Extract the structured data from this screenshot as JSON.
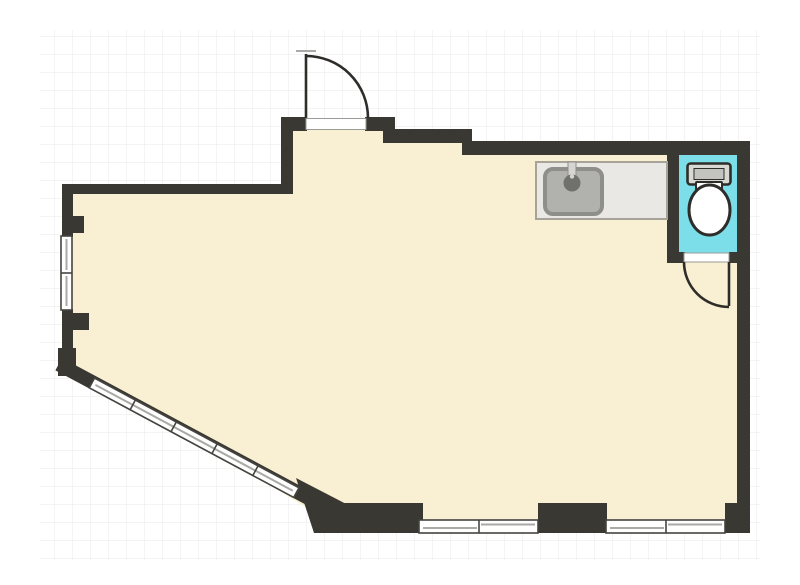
{
  "canvas": {
    "width": 800,
    "height": 585,
    "kind": "architectural-floor-plan"
  },
  "colors": {
    "background": "#ffffff",
    "grid_line": "#eaeaea",
    "wall": "#3a3833",
    "floor": "#f9efd2",
    "toilet_floor": "#7bdee9",
    "counter_fill": "#e9e8e4",
    "counter_border": "#a7a399",
    "sink_fill": "#b1b1ad",
    "sink_border": "#8e8e8a",
    "faucet": "#70706c",
    "faucet_stem": "#d6d5d1",
    "fixture_outline": "#2e2d29",
    "fixture_fill": "#ffffff",
    "tank_fill": "#d8d8d4",
    "tank_inner": "#c3c3bf",
    "window_fill": "#ffffff",
    "window_frame": "#45443f",
    "window_mullion": "#a9a9a5",
    "threshold_border": "#9a9a96",
    "door_stroke": "#2e2d29"
  },
  "elements": {
    "rooms": [
      {
        "name": "main-room"
      },
      {
        "name": "toilet-room"
      }
    ],
    "fixtures": [
      {
        "name": "kitchen-counter"
      },
      {
        "name": "kitchen-sink"
      },
      {
        "name": "faucet"
      },
      {
        "name": "toilet-tank"
      },
      {
        "name": "toilet-bowl"
      }
    ],
    "doors": [
      {
        "name": "entry-door",
        "swing": "quarter-arc-up"
      },
      {
        "name": "toilet-door",
        "swing": "quarter-arc-down"
      }
    ],
    "windows": [
      {
        "name": "left-wall-window",
        "panes": 2
      },
      {
        "name": "diagonal-wall-window",
        "panes": 5
      },
      {
        "name": "bottom-wall-window-left",
        "panes": 2
      },
      {
        "name": "bottom-wall-window-right",
        "panes": 2
      }
    ]
  }
}
